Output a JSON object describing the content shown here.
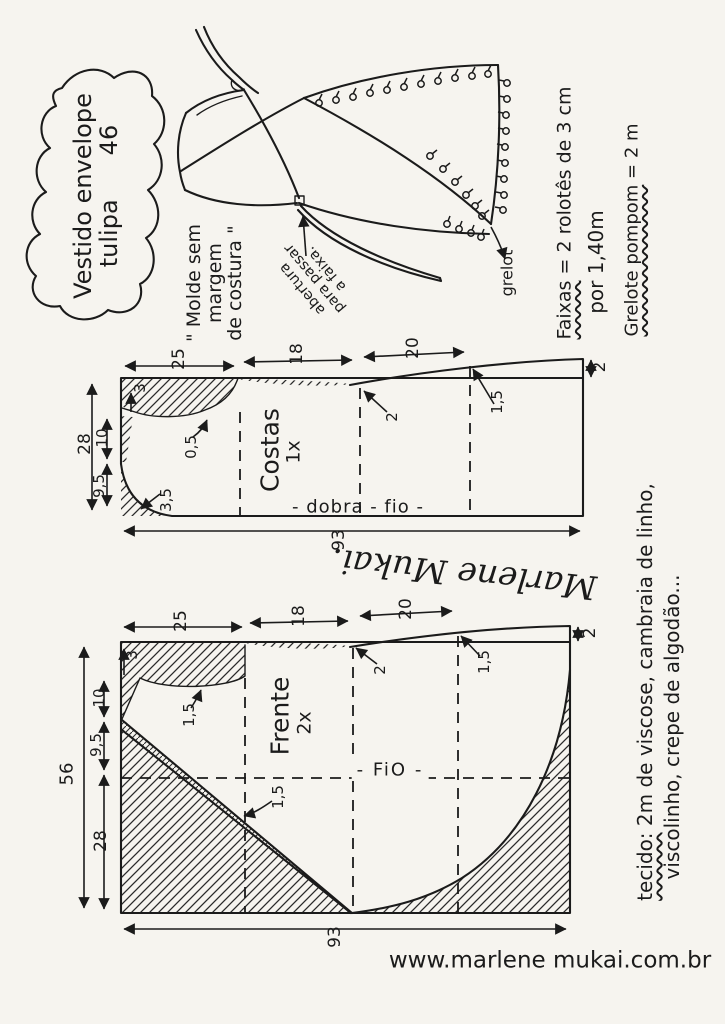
{
  "title": {
    "line1": "Vestido envelope",
    "line2_word": "tulipa",
    "size": "46"
  },
  "notes": {
    "faixas_label": "Faixas",
    "faixas_value": " = 2 rolotês de 3 cm",
    "faixas_line2": "por 1,40m",
    "grelote_label": "Grelote pompom",
    "grelote_value": " = 2 m",
    "mold_line1": "\" Molde sem",
    "mold_line2": "margem",
    "mold_line3": "de costura \"",
    "opening_line1": "abertura",
    "opening_line2": "para passar",
    "opening_line3": "a faixa.",
    "grelot_label": "grelot",
    "fabric_label": "tecido:",
    "fabric_line1": " 2m de viscose, cambraia de linho,",
    "fabric_line2": "viscolinho, crepe de algodão..."
  },
  "costas": {
    "name": "Costas",
    "qty": "1x",
    "fold_grain_label": "- dobra - fio -",
    "m_25": "25",
    "m_18": "18",
    "m_20": "20",
    "m_2_right": "2",
    "m_28": "28",
    "m_10": "10",
    "m_9_5": "9,5",
    "m_3": "3",
    "m_0_5": "0,5",
    "m_3_5": "3,5",
    "m_2_dart": "2",
    "m_1_5": "1,5",
    "m_93": "93"
  },
  "frente": {
    "name": "Frente",
    "qty": "2x",
    "grain_label": "- FiO -",
    "m_25": "25",
    "m_18": "18",
    "m_20": "20",
    "m_2_right": "2",
    "m_56": "56",
    "m_10": "10",
    "m_9_5": "9,5",
    "m_28": "28",
    "m_3": "3",
    "m_1_5_armhole": "1,5",
    "m_2_dart": "2",
    "m_1_5_side": "1,5",
    "m_1_5_hem": "1,5",
    "m_93": "93"
  },
  "signature": "Marlene Mukai.",
  "website": "www.marlene mukai.com.br"
}
